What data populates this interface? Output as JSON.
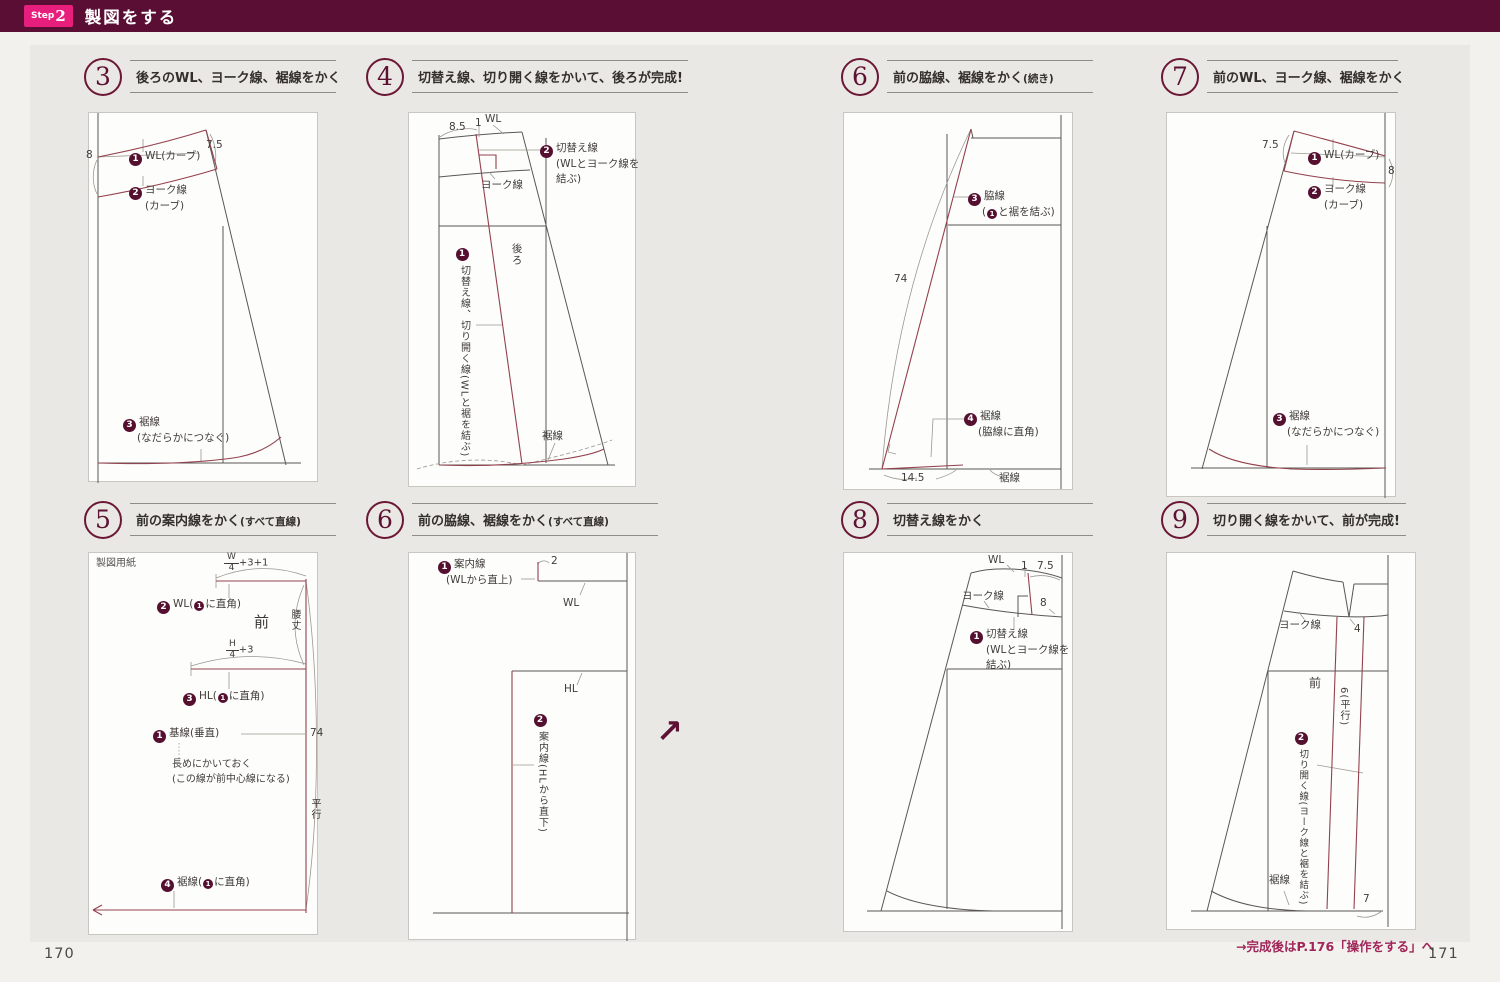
{
  "header": {
    "step_label": "Step",
    "step_number": "2",
    "title": "製図をする"
  },
  "page": {
    "left_number": "170",
    "right_number": "171",
    "footer_note": "→完成後はP.176「操作をする」へ",
    "continue_arrow": "↗"
  },
  "colors": {
    "header_bar": "#5a0e34",
    "badge_pink": "#e81e7c",
    "accent_maroon": "#5d1133",
    "pattern_red": "#93414d",
    "page_bg": "#e9e8e4"
  },
  "panels": {
    "p3": {
      "number": "3",
      "title": "後ろのWL、ヨーク線、裾線をかく",
      "labels": {
        "dim_left": "8",
        "dim_right": "7.5",
        "s1_n": "1",
        "s1_t": "WL(カーブ)",
        "s2_n": "2",
        "s2_l1": "ヨーク線",
        "s2_l2": "(カーブ)",
        "s3_n": "3",
        "s3_l1": "裾線",
        "s3_l2": "(なだらかにつなぐ)"
      }
    },
    "p4": {
      "number": "4",
      "title": "切替え線、切り開く線をかいて、後ろが完成!",
      "labels": {
        "dim_85": "8.5",
        "dim_1": "1",
        "wl": "WL",
        "s2_n": "2",
        "s2_l1": "切替え線",
        "s2_l2": "(WLとヨーク線を",
        "s2_l3": "結ぶ)",
        "yoke": "ヨーク線",
        "s1_n": "1",
        "s1_v": "切替え線、切り開く線(WLと裾を結ぶ)",
        "back": "後ろ",
        "hem": "裾線"
      }
    },
    "p5": {
      "number": "5",
      "title": "前の案内線をかく",
      "suffix": "(すべて直線)",
      "labels": {
        "paper": "製図用紙",
        "frac1_num": "W",
        "frac1_den": "4",
        "frac1_suffix": "+3+1",
        "s2_n": "2",
        "s2_pre": "WL(",
        "s2_in": "1",
        "s2_post": "に直角)",
        "front": "前",
        "waist_len": "腰丈",
        "frac2_num": "H",
        "frac2_den": "4",
        "frac2_suffix": "+3",
        "s3_n": "3",
        "s3_pre": "HL(",
        "s3_in": "1",
        "s3_post": "に直角)",
        "s1_n": "1",
        "s1_t": "基線(垂直)",
        "note1": "長めにかいておく",
        "note2": "(この線が前中心線になる)",
        "dim_74": "74",
        "parallel": "平行",
        "s4_n": "4",
        "s4_pre": "裾線(",
        "s4_in": "1",
        "s4_post": "に直角)"
      }
    },
    "p6l": {
      "number": "6",
      "title": "前の脇線、裾線をかく",
      "suffix": "(すべて直線)",
      "labels": {
        "s1_n": "1",
        "s1_l1": "案内線",
        "s1_l2": "(WLから直上)",
        "dim_2": "2",
        "wl": "WL",
        "hl": "HL",
        "s2_n": "2",
        "s2_v": "案内線(HLから直下)"
      }
    },
    "p6r": {
      "number": "6",
      "title": "前の脇線、裾線をかく",
      "suffix": "(続き)",
      "labels": {
        "s3_n": "3",
        "s3_l1": "脇線",
        "s3_pre": "(",
        "s3_in": "1",
        "s3_post": "と裾を結ぶ)",
        "dim_74": "74",
        "s4_n": "4",
        "s4_l1": "裾線",
        "s4_l2": "(脇線に直角)",
        "dim_145": "14.5",
        "hem": "裾線"
      }
    },
    "p7": {
      "number": "7",
      "title": "前のWL、ヨーク線、裾線をかく",
      "labels": {
        "dim_left": "7.5",
        "dim_right": "8",
        "s1_n": "1",
        "s1_t": "WL(カーブ)",
        "s2_n": "2",
        "s2_l1": "ヨーク線",
        "s2_l2": "(カーブ)",
        "s3_n": "3",
        "s3_l1": "裾線",
        "s3_l2": "(なだらかにつなぐ)"
      }
    },
    "p8": {
      "number": "8",
      "title": "切替え線をかく",
      "labels": {
        "wl": "WL",
        "dim_1": "1",
        "dim_75": "7.5",
        "yoke": "ヨーク線",
        "dim_8": "8",
        "s1_n": "1",
        "s1_l1": "切替え線",
        "s1_l2": "(WLとヨーク線を",
        "s1_l3": "結ぶ)"
      }
    },
    "p9": {
      "number": "9",
      "title": "切り開く線をかいて、前が完成!",
      "labels": {
        "yoke": "ヨーク線",
        "dim_4": "4",
        "front": "前",
        "dim_6v": "6(平行)",
        "s2_n": "2",
        "s2_v": "切り開く線(ヨーク線と裾を結ぶ)",
        "hem": "裾線",
        "dim_7": "7"
      }
    }
  }
}
